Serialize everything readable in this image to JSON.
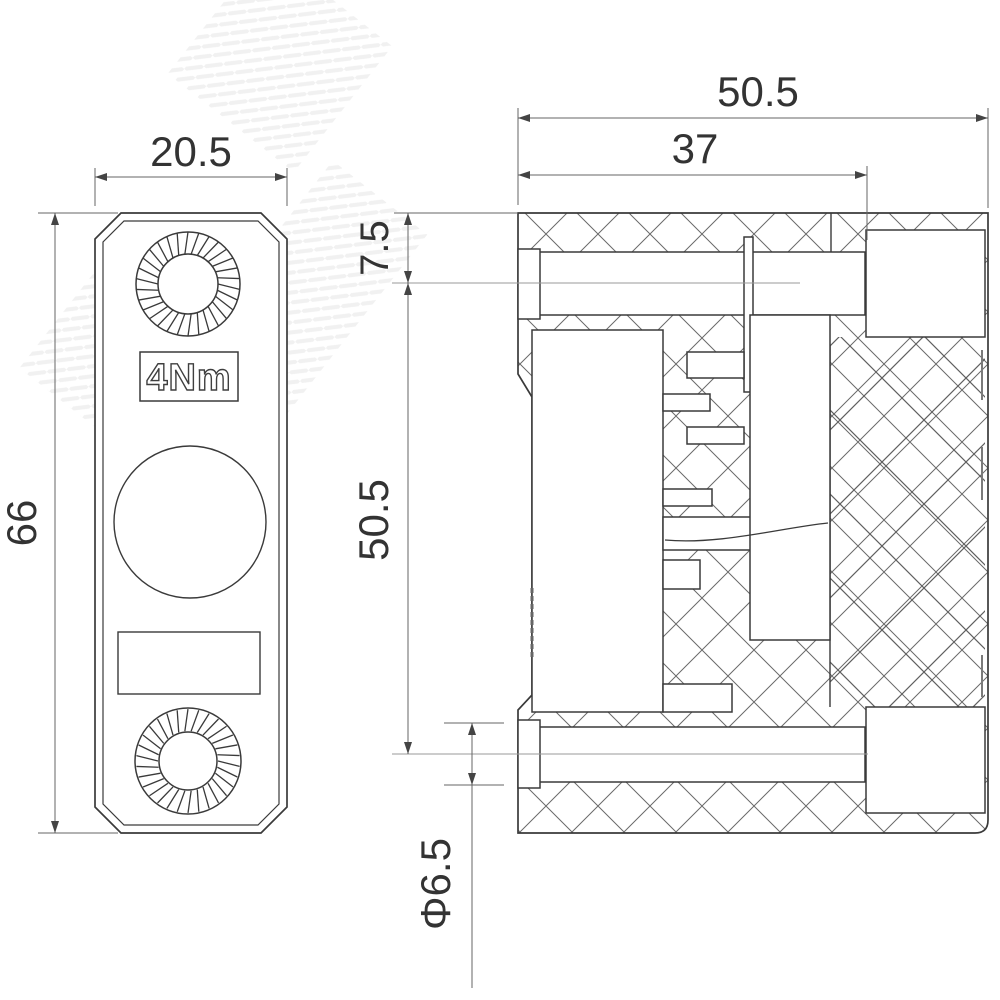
{
  "drawing": {
    "kind": "technical-drawing-two-views",
    "front_view": {
      "width_dim": "20.5",
      "height_dim": "66",
      "torque_label": "4Nm"
    },
    "section_view": {
      "overall_width_dim": "50.5",
      "inner_width_dim": "37",
      "hole_offset_dim": "7.5",
      "hole_spacing_dim": "50.5",
      "hole_diameter_dim": "Φ6.5"
    },
    "colors": {
      "outline": "#3a3a3a",
      "dim_line": "#555555",
      "hatch_fine": "#6a6a6a",
      "hatch_coarse": "#5f5f5f",
      "background": "#ffffff"
    }
  }
}
